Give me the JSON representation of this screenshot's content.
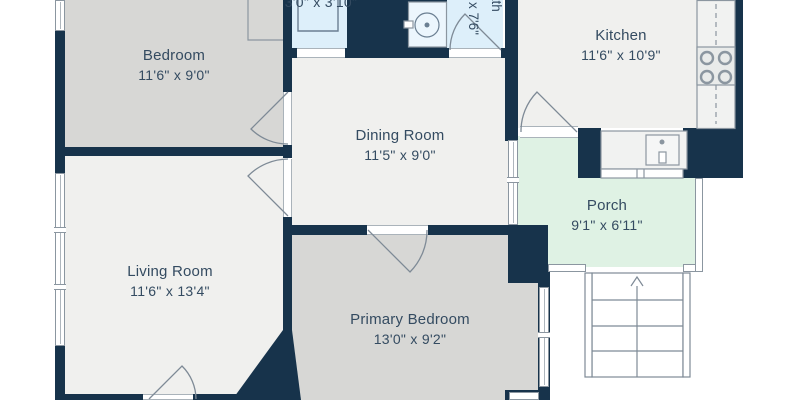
{
  "plan": {
    "rooms": {
      "bedroom": {
        "name": "Bedroom",
        "dims": "11'6\" x 9'0\""
      },
      "living_room": {
        "name": "Living Room",
        "dims": "11'6\" x 13'4\""
      },
      "dining_room": {
        "name": "Dining Room",
        "dims": "11'5\" x 9'0\""
      },
      "kitchen": {
        "name": "Kitchen",
        "dims": "11'6\" x 10'9\""
      },
      "primary_bedroom": {
        "name": "Primary Bedroom",
        "dims": "13'0\" x 9'2\""
      },
      "porch": {
        "name": "Porch",
        "dims": "9'1\" x 6'11\""
      },
      "bath": {
        "name": "Bath",
        "dims_visible": "x 7'6\""
      },
      "closet": {
        "dims": "3'0\" x 3'10\""
      }
    },
    "colors": {
      "wall": "#17334b",
      "bedroom_fill": "#d7d7d5",
      "main_fill": "#f0f0ee",
      "wet_room_fill": "#ddeffa",
      "porch_fill": "#dff2e4",
      "line": "#8b96a0",
      "text": "#344b61",
      "background": "#ffffff"
    }
  }
}
